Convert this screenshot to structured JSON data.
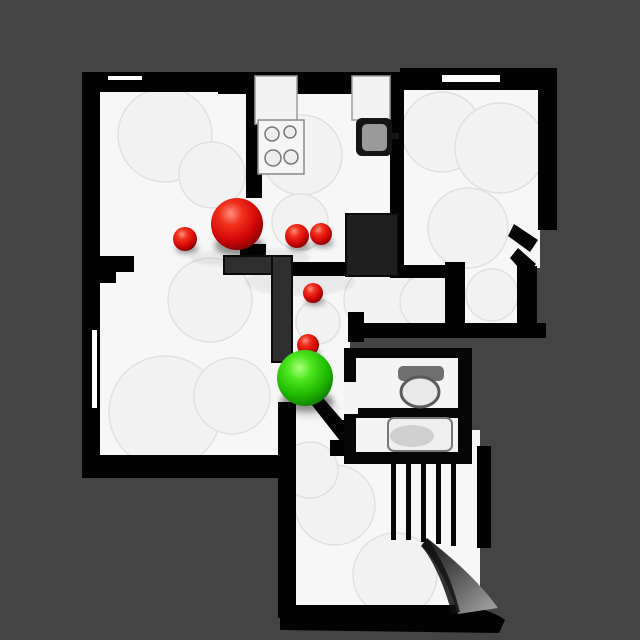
{
  "scene": {
    "kind": "top-down-floorplan-navigation-map",
    "background_color": "#444444",
    "floor_color": "#f7f7f7",
    "wall_color": "#000000",
    "inner_wall_color": "#2f2f2f",
    "canvas": {
      "width": 640,
      "height": 640
    }
  },
  "markers": {
    "target_color": "#d40808",
    "agent_color": "#1fb900",
    "targets": [
      {
        "x": 237,
        "y": 224,
        "r": 26
      },
      {
        "x": 185,
        "y": 239,
        "r": 12
      },
      {
        "x": 297,
        "y": 236,
        "r": 12
      },
      {
        "x": 321,
        "y": 234,
        "r": 11
      },
      {
        "x": 313,
        "y": 293,
        "r": 10
      },
      {
        "x": 308,
        "y": 345,
        "r": 11
      }
    ],
    "agent": {
      "x": 305,
      "y": 378,
      "r": 28
    }
  }
}
